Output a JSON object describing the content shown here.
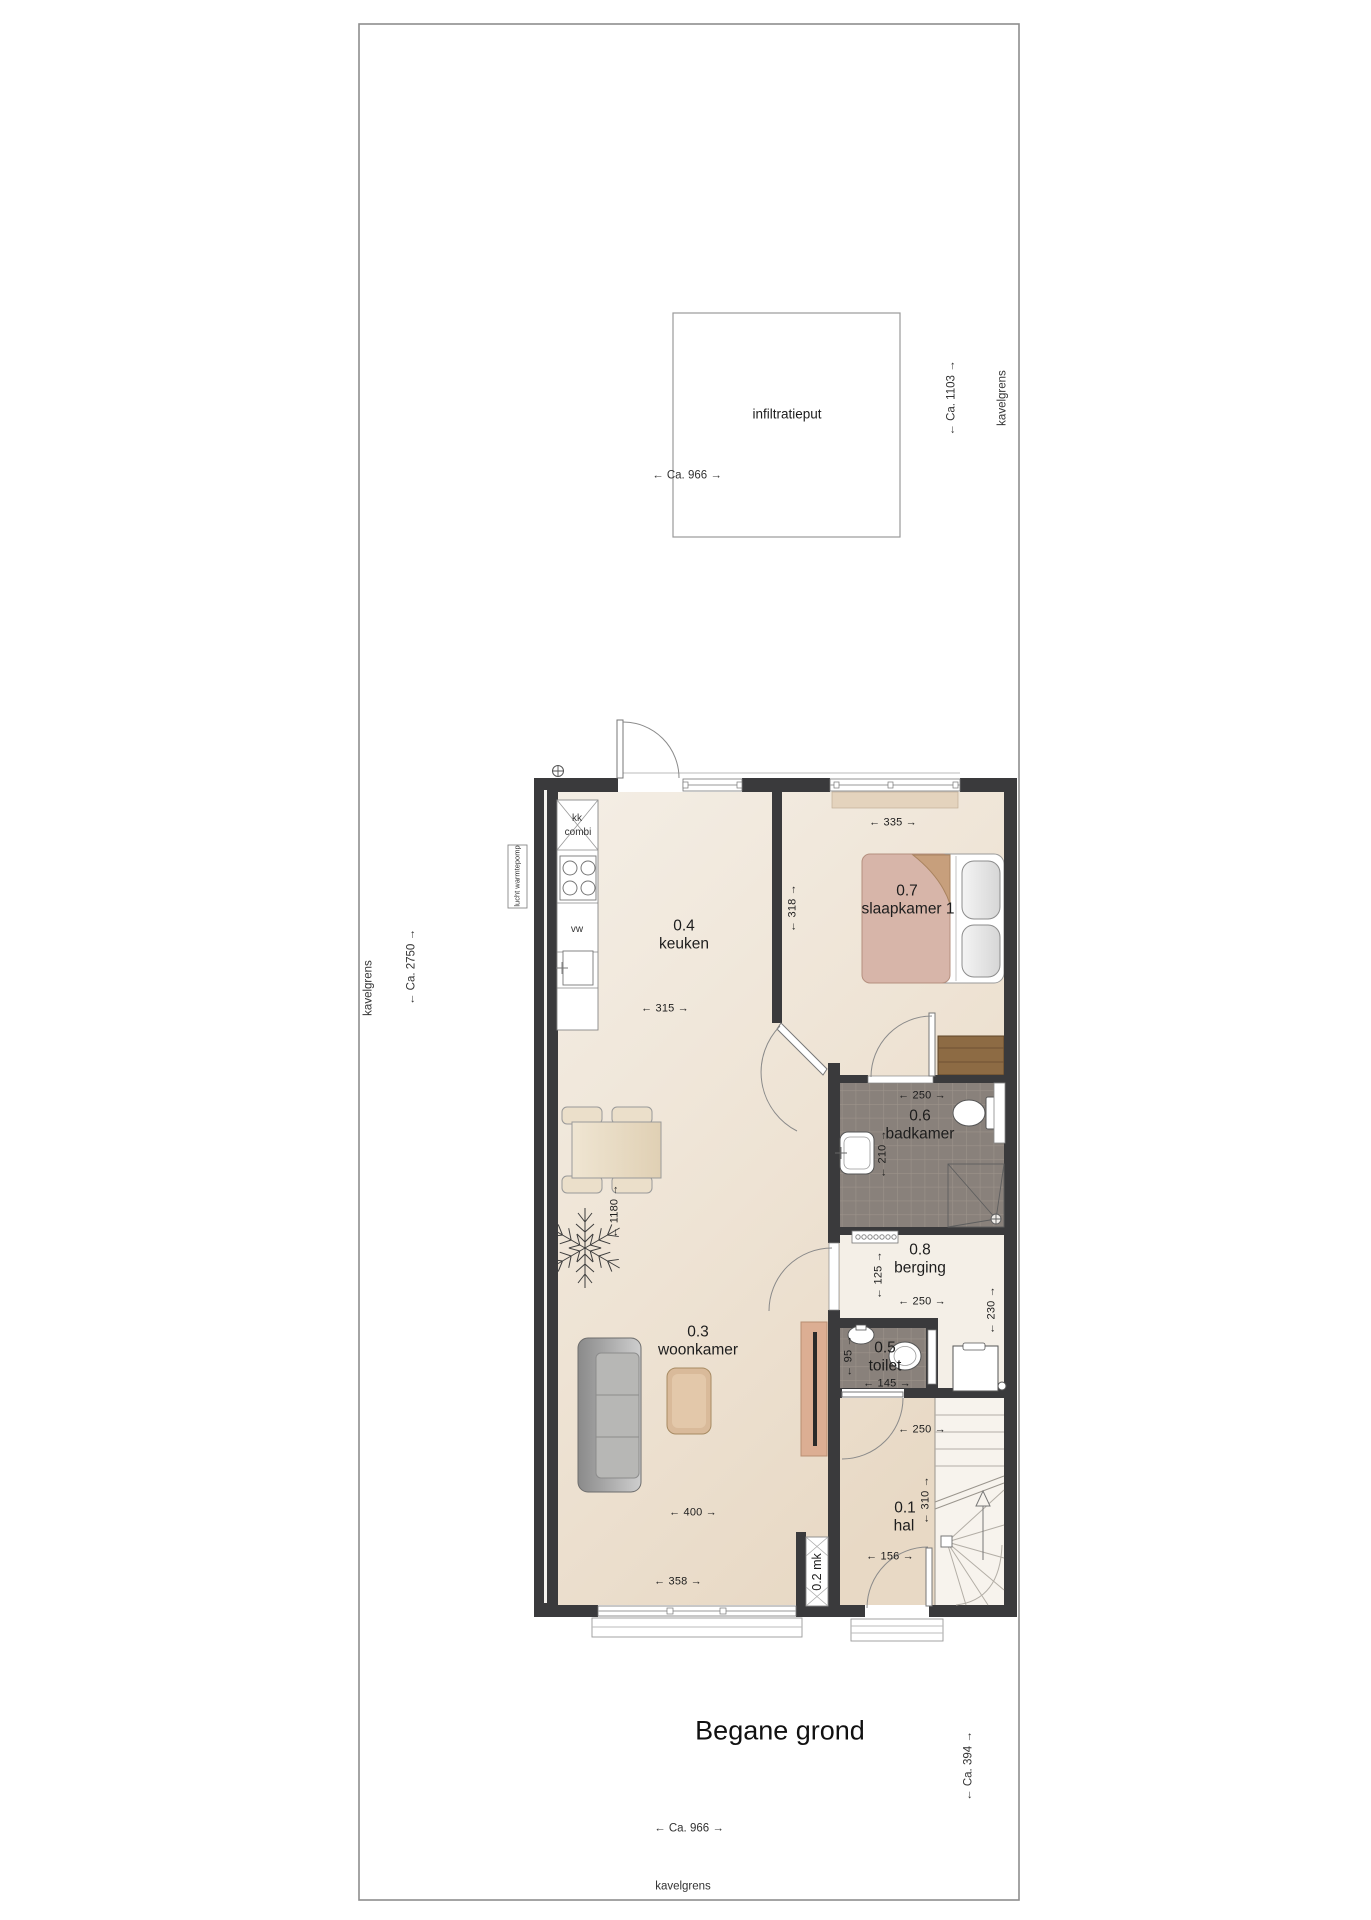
{
  "title": "Begane grond",
  "site": {
    "infiltratieput_label": "infiltratieput",
    "kavelgrens_left": "kavelgrens",
    "kavelgrens_right": "kavelgrens",
    "kavelgrens_bottom": "kavelgrens",
    "dim_top_width": "← Ca. 966 →",
    "dim_bottom_width": "← Ca. 966 →",
    "dim_right_upper": "← Ca. 1103 →",
    "dim_left_depth": "← Ca. 2750 →",
    "dim_right_lower": "← Ca. 394 →"
  },
  "rooms": {
    "hal": {
      "number": "0.1",
      "name": "hal"
    },
    "meterkast": {
      "label": "0.2 mk"
    },
    "woonkamer": {
      "number": "0.3",
      "name": "woonkamer"
    },
    "keuken": {
      "number": "0.4",
      "name": "keuken"
    },
    "toilet": {
      "number": "0.5",
      "name": "toilet"
    },
    "badkamer": {
      "number": "0.6",
      "name": "badkamer"
    },
    "slaapkamer": {
      "number": "0.7",
      "name": "slaapkamer 1"
    },
    "berging": {
      "number": "0.8",
      "name": "berging"
    }
  },
  "dimensions": {
    "keuken_width": "← 315 →",
    "keuken_depth": "← 318 →",
    "slaapkamer_width": "← 335 →",
    "badkamer_width": "← 250 →",
    "badkamer_depth": "← 210 →",
    "berging_depth": "← 125 →",
    "berging_width": "← 250 →",
    "berging_right_depth": "← 230 →",
    "toilet_depth": "← 95 →",
    "toilet_width": "← 145 →",
    "hal_width": "← 250 →",
    "hal_depth": "← 310 →",
    "hal_lower_width": "← 156 →",
    "woonkamer_width": "← 400 →",
    "woonkamer_window_width": "← 358 →",
    "interior_depth": "← 1180 →"
  },
  "fixtures": {
    "fridge_line1": "kk",
    "fridge_line2": "combi",
    "dishwasher": "vw",
    "heatpump": "lucht warmtepomp"
  }
}
